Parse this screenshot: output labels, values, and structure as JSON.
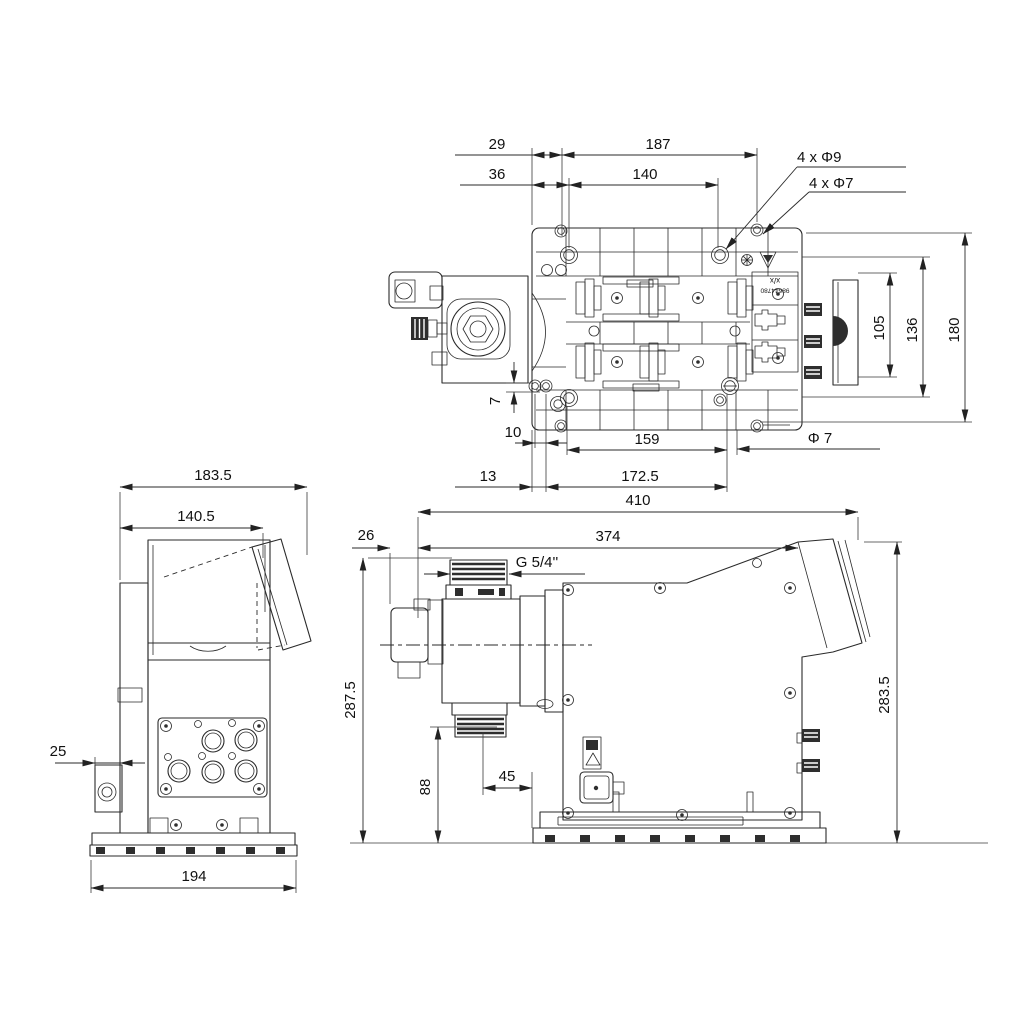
{
  "palette": {
    "background": "#ffffff",
    "ink": "#2a2a2a",
    "dim_text": "#111111",
    "dark_fill": "#2e2e2e"
  },
  "icons": {
    "recycle": "gear-flower mark",
    "warning": "down-triangle mark"
  },
  "top_view": {
    "dims": {
      "w29": "29",
      "w187": "187",
      "w36": "36",
      "w140": "140",
      "h105": "105",
      "h136": "136",
      "h180": "180",
      "v7": "7",
      "w10": "10",
      "w159": "159",
      "w13": "13",
      "w172_5": "172.5"
    },
    "notes": {
      "holes_9": "4 x Φ9",
      "holes_7": "4 x Φ7",
      "dia_7": "Φ 7"
    },
    "plate_label": {
      "line1": "x/x",
      "line2": "98644780"
    }
  },
  "end_view": {
    "dims": {
      "w183_5": "183.5",
      "w140_5": "140.5",
      "w25": "25",
      "w194": "194"
    }
  },
  "side_view": {
    "dims": {
      "w410": "410",
      "w26": "26",
      "w374": "374",
      "h287_5": "287.5",
      "h88": "88",
      "w45": "45",
      "h283_5": "283.5"
    },
    "notes": {
      "thread": "G 5/4''"
    }
  }
}
